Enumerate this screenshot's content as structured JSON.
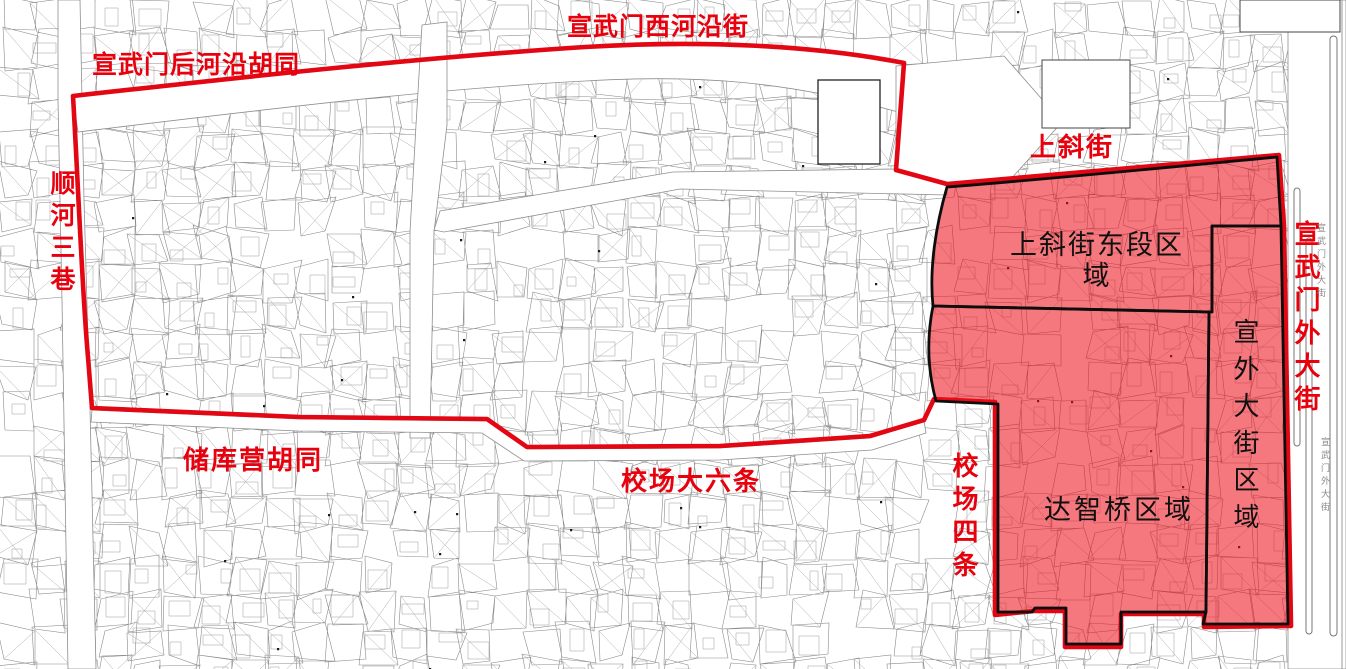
{
  "colors": {
    "boundary_red": "#e30613",
    "region_fill_red": "rgba(235,15,25,0.56)",
    "street_label_red": "#e8000d",
    "region_label_black": "#101010",
    "region_outline_black": "#0d0d0d",
    "parcel_line_gray": "#8b8b8b",
    "road_annotation_gray": "#8a8a8a"
  },
  "streets": [
    {
      "text": "宣武门后河沿胡同",
      "orientation": "horizontal",
      "color": "red"
    },
    {
      "text": "宣武门西河沿街",
      "orientation": "horizontal",
      "color": "red"
    },
    {
      "text": "上斜街",
      "orientation": "horizontal",
      "color": "red"
    },
    {
      "text": "顺河三巷",
      "orientation": "vertical",
      "color": "red"
    },
    {
      "text": "储库营胡同",
      "orientation": "horizontal",
      "color": "red"
    },
    {
      "text": "校场大六条",
      "orientation": "horizontal",
      "color": "red"
    },
    {
      "text": "校场四条",
      "orientation": "vertical",
      "color": "red"
    },
    {
      "text": "宣武门外大街",
      "orientation": "vertical",
      "color": "red"
    }
  ],
  "regions": [
    {
      "text": "上斜街东段区域"
    },
    {
      "text": "达智桥区域"
    },
    {
      "text": "宣外大街区域"
    }
  ],
  "road_annotations": [
    {
      "text": "宣武门外大街"
    },
    {
      "text": "宣武门外大街"
    }
  ]
}
